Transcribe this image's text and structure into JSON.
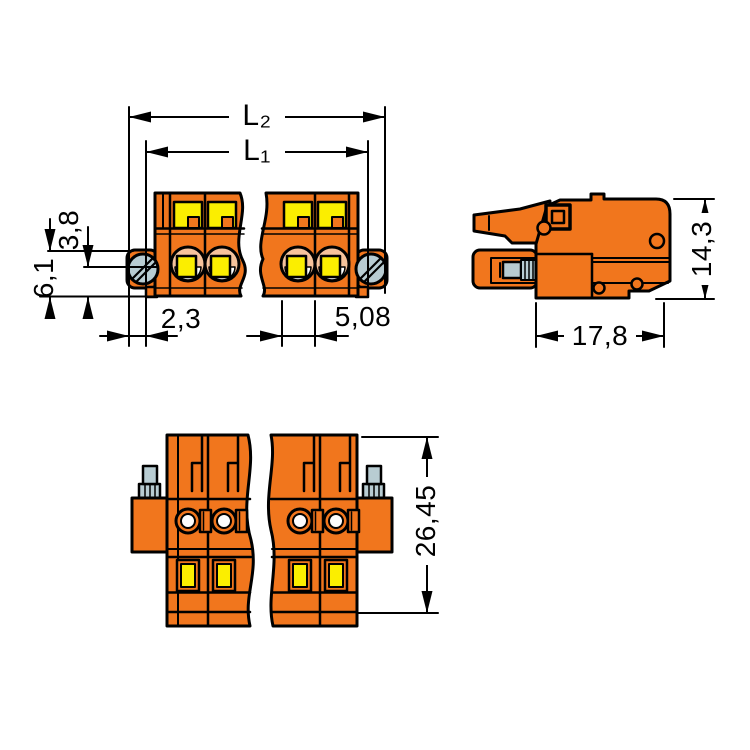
{
  "drawing": {
    "type": "technical-dimension-drawing",
    "views": [
      "front-view-with-break",
      "side-view",
      "bottom-view-with-break"
    ],
    "dimensions": {
      "overall_length": "L₂",
      "housing_length": "L₁",
      "screw_to_top": "3,8",
      "screw_to_bottom": "6,1",
      "edge_to_screw": "2,3",
      "pole_pitch": "5,08",
      "depth": "17,8",
      "height": "14,3",
      "overall_height": "26,45"
    },
    "colors": {
      "housing_orange": "#F1761D",
      "insert_yellow": "#FBEE00",
      "clamp_salmon": "#F6C39C",
      "screw_gray": "#B8CCD2",
      "line_black": "#000000",
      "background": "#FFFFFF"
    }
  }
}
